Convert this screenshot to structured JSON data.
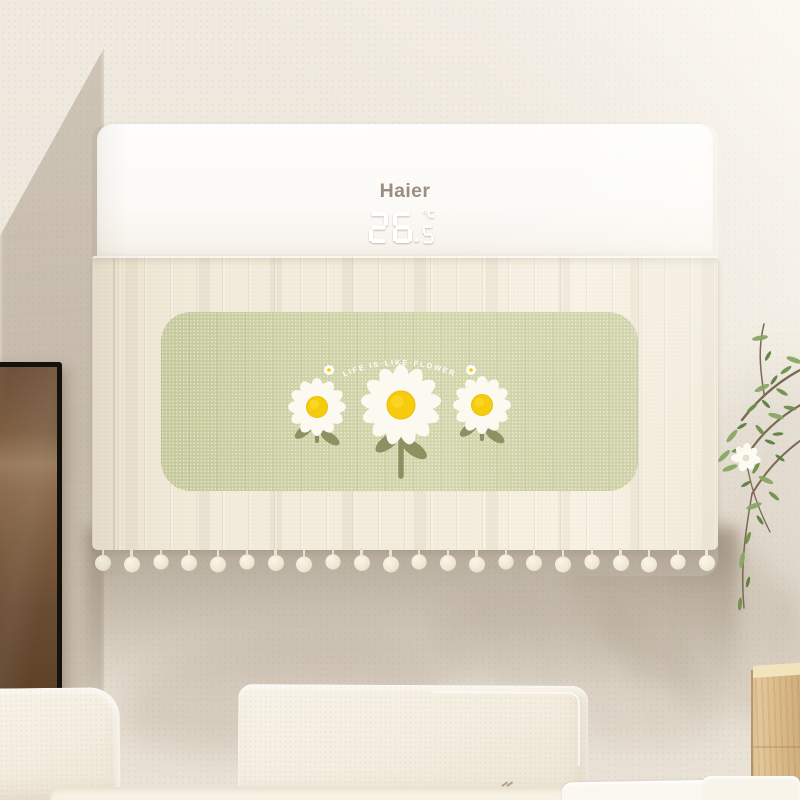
{
  "ac": {
    "brand": "Haier",
    "display": {
      "temperature": "26.5",
      "unit": "℃"
    }
  },
  "cover": {
    "slogan": "LIFE IS·LIKE·FLOWER",
    "flowers": [
      {
        "size": "small"
      },
      {
        "size": "large"
      },
      {
        "size": "small"
      }
    ],
    "pompom_count": 22
  },
  "palette": {
    "wall": "#ece5da",
    "wall_shadow": "#c8bcab",
    "ac_body": "#fdfcfa",
    "brand_text": "#9a8c7e",
    "lcd": "#ffffff",
    "fabric": "#f2ebdb",
    "panel_green": "#cbcfa4",
    "petal_white": "#fcf9f0",
    "flower_yellow": "#f6cb0b",
    "stem_olive": "#8b9160",
    "slogan_white": "#fdfdfa",
    "frame_black": "#15110d",
    "frame_art": "#8a6a4b",
    "plant_green": "#7d9b55",
    "branch_brown": "#7c6952",
    "wood": "#dcbf92",
    "sofa_cream": "#f4eee1"
  }
}
